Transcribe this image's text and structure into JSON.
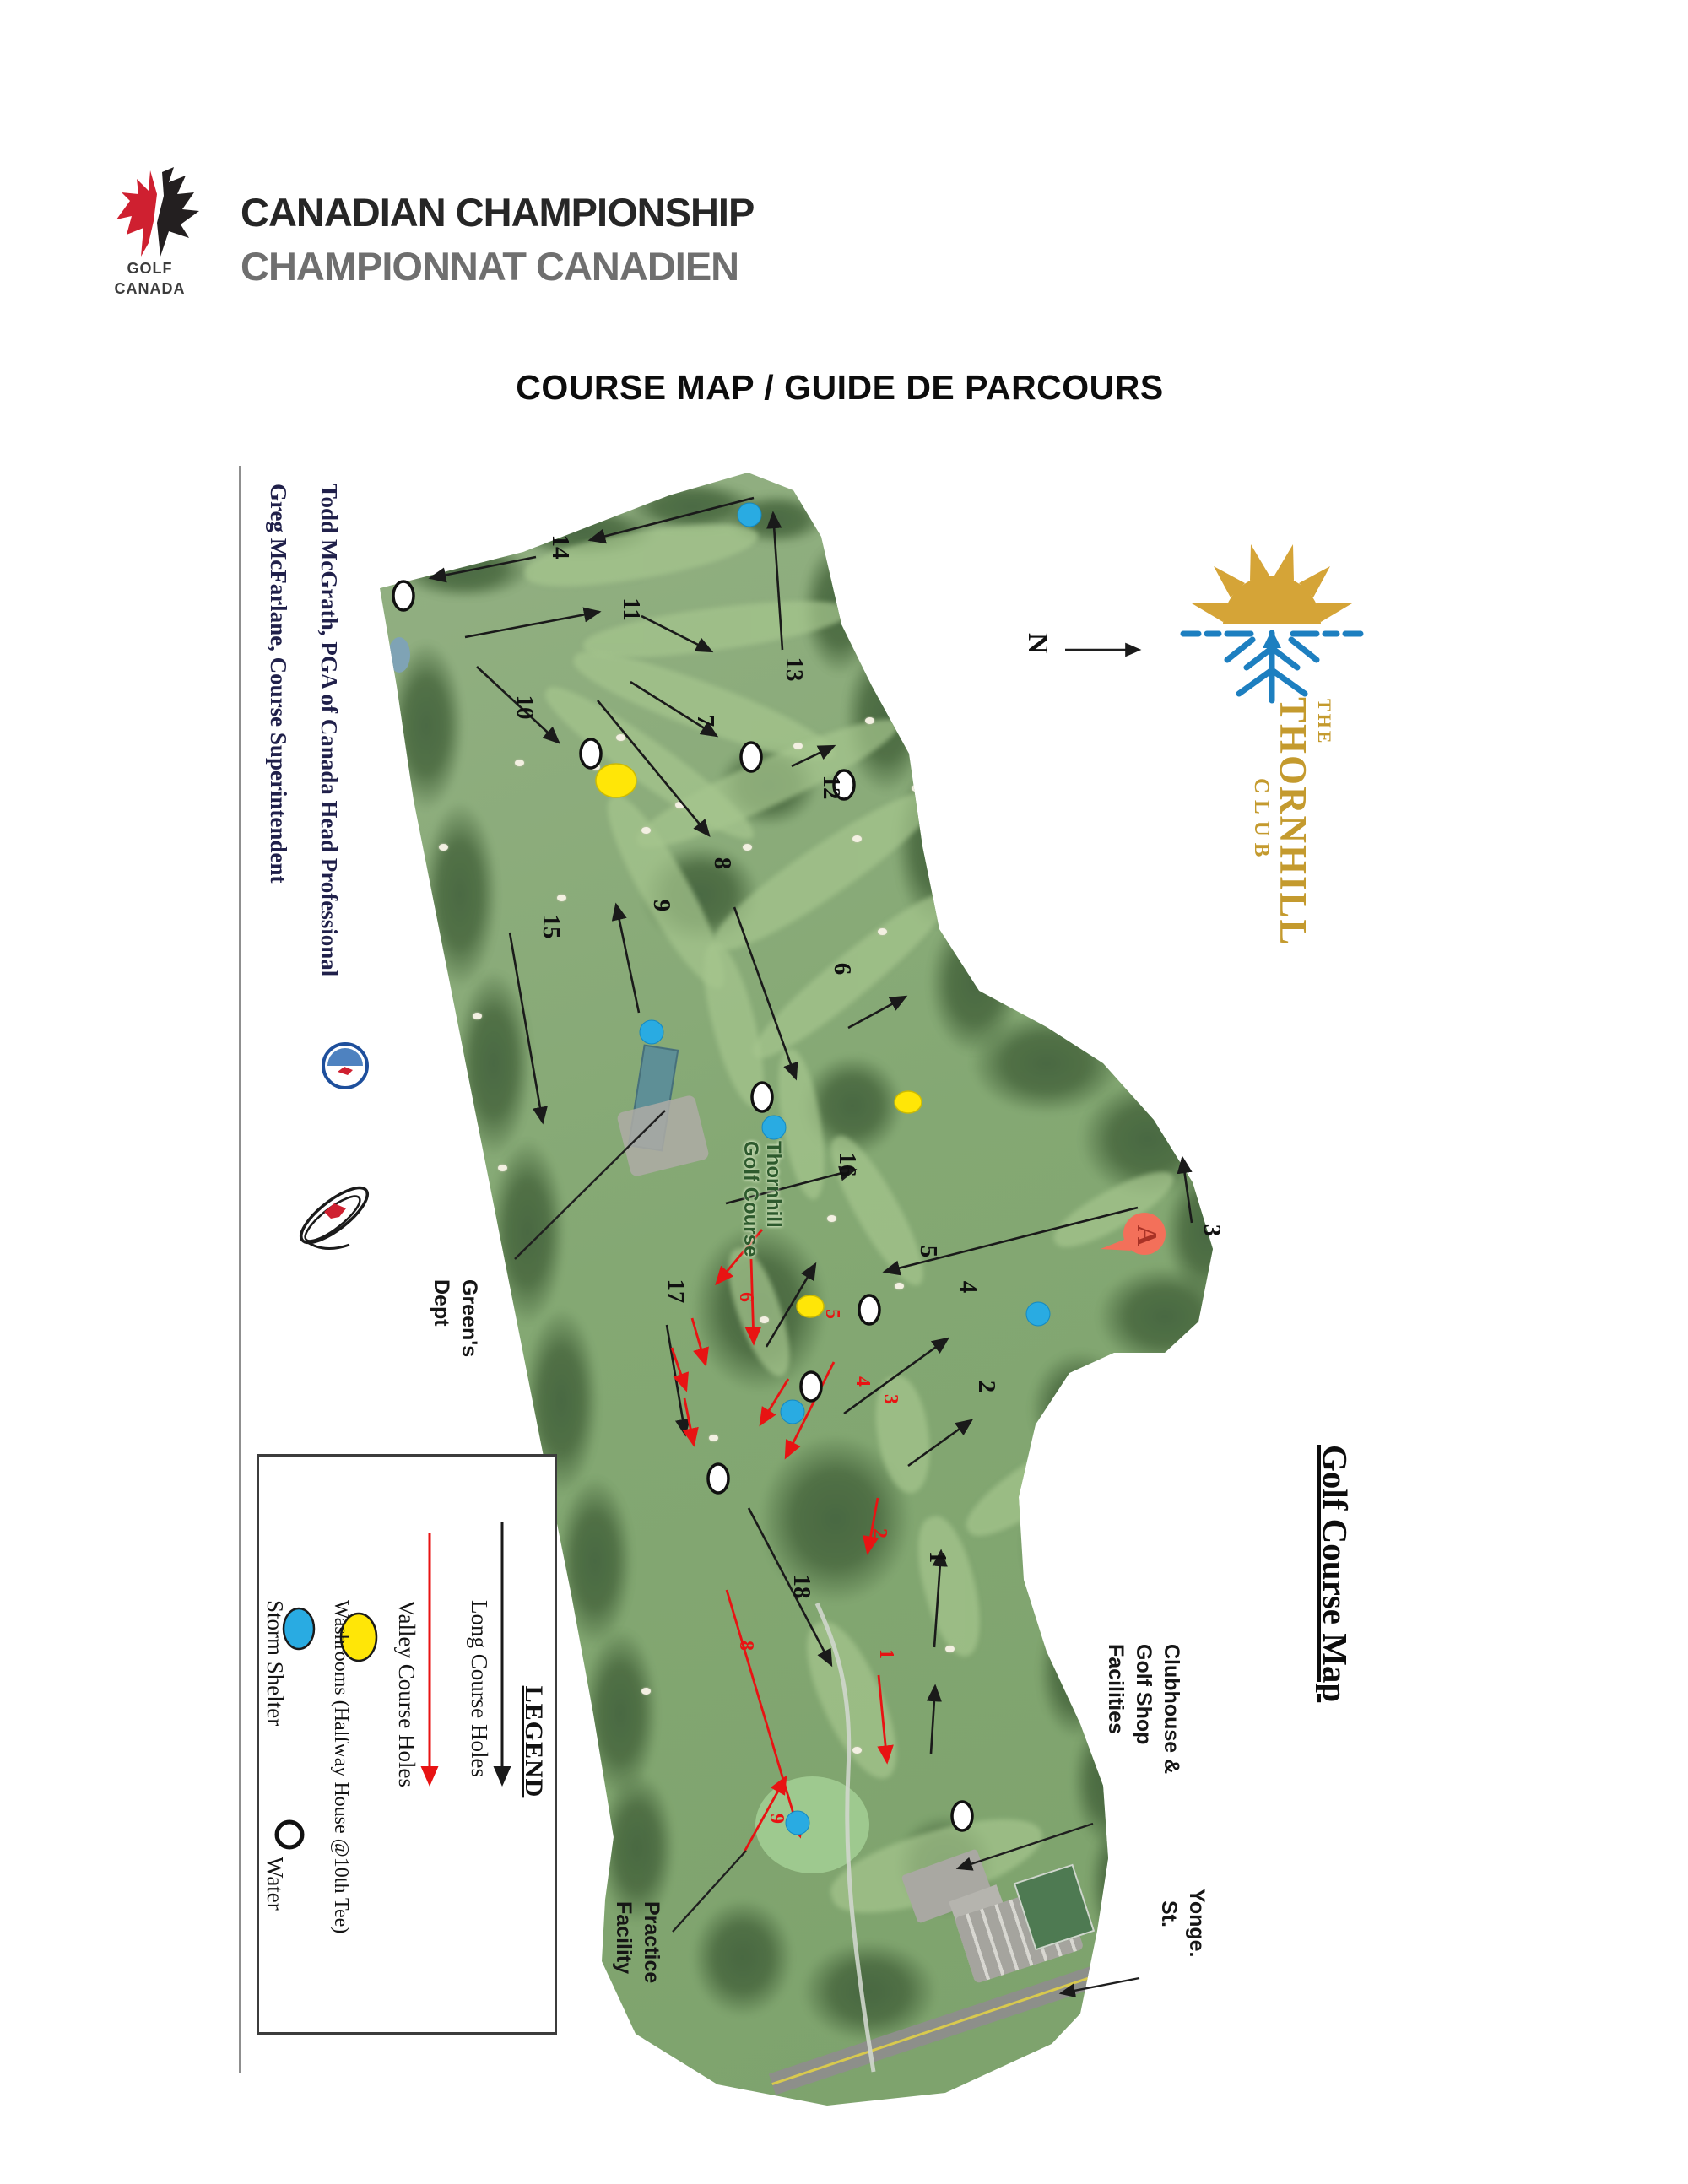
{
  "header": {
    "logo": {
      "line1": "GOLF",
      "line2": "CANADA"
    },
    "title_en": "CANADIAN CHAMPIONSHIP",
    "title_fr": "CHAMPIONNAT CANADIEN"
  },
  "page_title": "COURSE MAP / GUIDE DE PARCOURS",
  "credits": {
    "line1": "Todd McGrath, PGA of Canada Head Professional",
    "line2": "Greg McFarlane, Course Superintendent"
  },
  "club_logo": {
    "line1": "THE",
    "line2": "THORNHILL",
    "line3": "CLUB"
  },
  "compass": {
    "label": "N"
  },
  "map_title": "Golf Course Map",
  "watermark": {
    "line1": "Thornhill",
    "line2": "Golf Course"
  },
  "labels": {
    "greens_dept": {
      "lines": [
        "Green's",
        "Dept"
      ]
    },
    "clubhouse": {
      "lines": [
        "Clubhouse &",
        "Golf Shop",
        "Facilities"
      ]
    },
    "practice": {
      "lines": [
        "Practice",
        "Facility"
      ]
    },
    "street": {
      "lines": [
        "Yonge.",
        "St."
      ]
    }
  },
  "legend": {
    "title": "LEGEND",
    "items": [
      {
        "symbol": "black-arrow",
        "label": "Long Course Holes"
      },
      {
        "symbol": "red-arrow",
        "label": "Valley Course Holes"
      },
      {
        "symbol": "yellow-ellipse",
        "label": "Washrooms (Halfway House @10th Tee)"
      },
      {
        "symbol": "blue-ellipse",
        "label": "Storm Shelter"
      }
    ],
    "water": {
      "symbol": "open-circle",
      "label": "Water"
    }
  },
  "flag": {
    "letter": "A"
  },
  "colors": {
    "storm_shelter": "#29abe2",
    "washroom": "#ffe607",
    "valley_arrow": "#e81313",
    "long_arrow": "#1a1a1a",
    "club_gold": "#c49a2e",
    "club_blue": "#1d7fc0",
    "flag_red": "#f3705a"
  },
  "map_data": {
    "holes_long": [
      [
        "14",
        655,
        648
      ],
      [
        "11",
        739,
        722
      ],
      [
        "13",
        932,
        793
      ],
      [
        "7",
        827,
        854
      ],
      [
        "12",
        976,
        933
      ],
      [
        "10",
        613,
        838
      ],
      [
        "8",
        847,
        1023
      ],
      [
        "9",
        775,
        1073
      ],
      [
        "15",
        644,
        1098
      ],
      [
        "6",
        989,
        1148
      ],
      [
        "16",
        995,
        1380
      ],
      [
        "17",
        792,
        1530
      ],
      [
        "5",
        1091,
        1483
      ],
      [
        "4",
        1138,
        1525
      ],
      [
        "3",
        1427,
        1458
      ],
      [
        "2",
        1160,
        1643
      ],
      [
        "1",
        1102,
        1845
      ],
      [
        "18",
        941,
        1880
      ]
    ],
    "holes_valley": [
      [
        "6",
        877,
        1537
      ],
      [
        "5",
        979,
        1557
      ],
      [
        "4",
        1015,
        1637
      ],
      [
        "3",
        1048,
        1658
      ],
      [
        "2",
        1035,
        1817
      ],
      [
        "1",
        1043,
        1960
      ],
      [
        "8",
        877,
        1950
      ],
      [
        "9",
        913,
        2155
      ]
    ],
    "arrows_long": [
      [
        893,
        590,
        699,
        640
      ],
      [
        635,
        660,
        510,
        685
      ],
      [
        551,
        755,
        710,
        725
      ],
      [
        760,
        730,
        843,
        772
      ],
      [
        927,
        770,
        916,
        608
      ],
      [
        747,
        808,
        849,
        872
      ],
      [
        938,
        908,
        988,
        884
      ],
      [
        565,
        790,
        662,
        880
      ],
      [
        708,
        830,
        840,
        990
      ],
      [
        757,
        1200,
        730,
        1072
      ],
      [
        604,
        1105,
        643,
        1330
      ],
      [
        870,
        1075,
        943,
        1278
      ],
      [
        1005,
        1218,
        1073,
        1181
      ],
      [
        860,
        1426,
        1013,
        1386
      ],
      [
        908,
        1596,
        966,
        1498
      ],
      [
        1000,
        1675,
        1123,
        1586
      ],
      [
        1412,
        1449,
        1401,
        1372
      ],
      [
        1348,
        1431,
        1048,
        1507
      ],
      [
        1076,
        1737,
        1151,
        1683
      ],
      [
        1107,
        1952,
        1115,
        1838
      ],
      [
        1103,
        2078,
        1108,
        1998
      ],
      [
        887,
        1787,
        985,
        1973
      ],
      [
        790,
        1570,
        812,
        1700
      ]
    ],
    "arrows_valley": [
      [
        903,
        1457,
        849,
        1521
      ],
      [
        890,
        1492,
        893,
        1592
      ],
      [
        820,
        1562,
        836,
        1617
      ],
      [
        796,
        1597,
        813,
        1647
      ],
      [
        811,
        1657,
        822,
        1712
      ],
      [
        934,
        1634,
        901,
        1688
      ],
      [
        988,
        1614,
        931,
        1727
      ],
      [
        1040,
        1775,
        1028,
        1840
      ],
      [
        1041,
        1985,
        1051,
        2088
      ],
      [
        861,
        1884,
        948,
        2176
      ],
      [
        881,
        2196,
        931,
        2106
      ]
    ],
    "pointers": [
      [
        610,
        1492,
        788,
        1316,
        0
      ],
      [
        797,
        2289,
        884,
        2193,
        0
      ],
      [
        1295,
        2161,
        1135,
        2214,
        1
      ],
      [
        1350,
        2344,
        1257,
        2362,
        1
      ],
      [
        1262,
        770,
        1350,
        770,
        1
      ]
    ],
    "markers": {
      "storm": [
        [
          888,
          610
        ],
        [
          772,
          1223
        ],
        [
          917,
          1336
        ],
        [
          939,
          1673
        ],
        [
          1230,
          1557
        ],
        [
          945,
          2160
        ]
      ],
      "water": [
        [
          478,
          706
        ],
        [
          700,
          893
        ],
        [
          890,
          897
        ],
        [
          1000,
          930
        ],
        [
          903,
          1300
        ],
        [
          1030,
          1552
        ],
        [
          961,
          1643
        ],
        [
          851,
          1752
        ],
        [
          1140,
          2152
        ]
      ],
      "washrooms": [
        [
          730,
          925,
          24,
          20
        ],
        [
          1076,
          1306,
          16,
          13
        ],
        [
          960,
          1548,
          16,
          13
        ]
      ]
    },
    "flag_pos": [
      1348,
      1462
    ]
  }
}
